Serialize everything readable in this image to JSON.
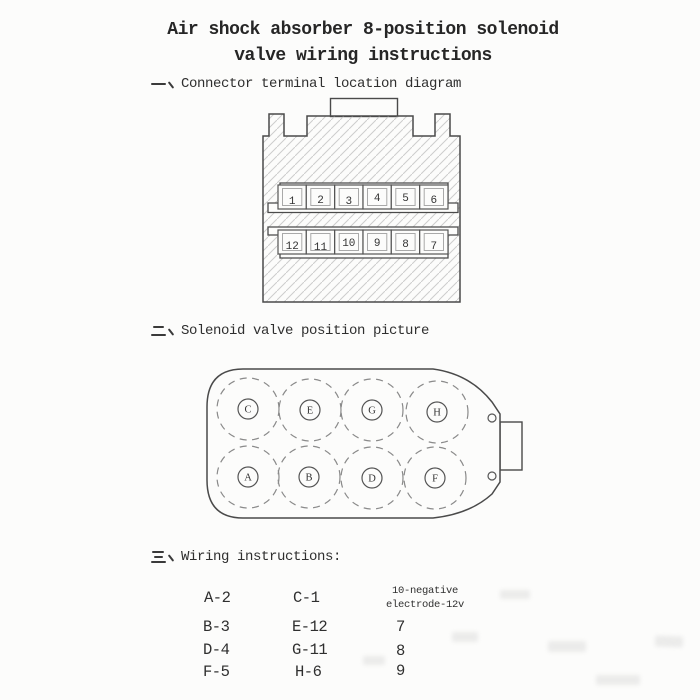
{
  "title": {
    "line1": "Air shock absorber 8-position solenoid",
    "line2": "valve wiring instructions"
  },
  "sections": {
    "one": {
      "marker": "一、",
      "heading": "Connector terminal location diagram"
    },
    "two": {
      "marker": "二、",
      "heading": "Solenoid valve position picture"
    },
    "three": {
      "marker": "三、",
      "heading": "Wiring instructions:"
    }
  },
  "connector_diagram": {
    "top_row": [
      "1",
      "2",
      "3",
      "4",
      "5",
      "6"
    ],
    "bottom_row": [
      "12",
      "11",
      "10",
      "9",
      "8",
      "7"
    ]
  },
  "valve_diagram": {
    "top_row": [
      "C",
      "E",
      "G",
      "H"
    ],
    "bottom_row": [
      "A",
      "B",
      "D",
      "F"
    ]
  },
  "wiring_table": {
    "col1": [
      "A-2",
      "B-3",
      "D-4",
      "F-5"
    ],
    "col2": [
      "C-1",
      "E-12",
      "G-11",
      "H-6"
    ],
    "col3_header": {
      "line1": "10-negative",
      "line2": "electrode-12v"
    },
    "col3": [
      "7",
      "8",
      "9"
    ]
  },
  "colors": {
    "ink": "#2f2f2f",
    "line": "#4a4a4a",
    "hatch": "#cdcdcd",
    "paper": "#fcfcfb"
  }
}
